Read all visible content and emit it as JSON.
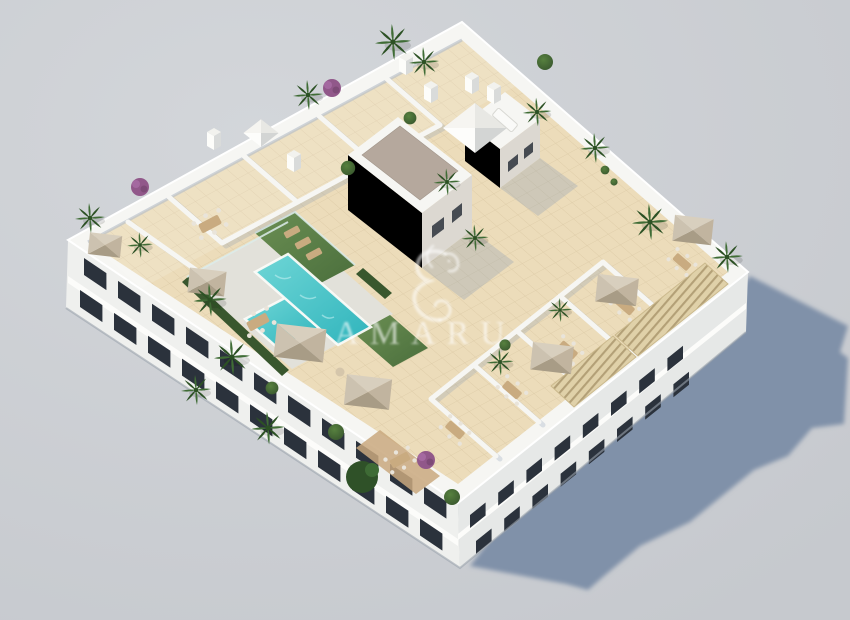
{
  "image": {
    "alt_text": "Aerial 3D render of a white residential building rooftop solarium with communal pool, lawns, terraces, parasols and plants"
  },
  "watermark": {
    "brand_text": "AMARU",
    "logo_icon": "seahorse-logo"
  },
  "palette": {
    "background_light": "#d3d6da",
    "background": "#c6c9ce",
    "shadow": "#8091a9",
    "wall_white": "#f6f6f3",
    "facade_left": "#eff0ee",
    "facade_right": "#e6e8e7",
    "window_dark": "#2b323c",
    "slab_white": "#fcfcfa",
    "tile": "#ecdcba",
    "tile_line": "#d8c49e",
    "deck_pale": "#e2e1da",
    "pool_light": "#6fd6d6",
    "pool": "#2fb4bc",
    "lawn_light": "#6b8f53",
    "lawn": "#4a6e3c",
    "hedge": "#39572e",
    "gravel_roof": "#b5a89d",
    "core_wall_shaded": "#dcd8d1",
    "core_wall_lit": "#ececе8",
    "umbrella_n": "#d8cfbe",
    "umbrella_e": "#c1b49f",
    "umbrella_s": "#a89c86",
    "umbrella_w": "#ccc2b0",
    "pergola": "#e0d1a9",
    "pergola_line": "#b3a077",
    "palm": "#3f6c35",
    "palm_dark": "#2c5124",
    "bush": "#57813f",
    "bougainvillea": "#91588a",
    "wood": "#c9a87e",
    "furniture_tan": "#c9ab80",
    "chair_light": "#e9e4da",
    "soft_shadow": "#8398b4",
    "watermark": "#ffffff"
  }
}
